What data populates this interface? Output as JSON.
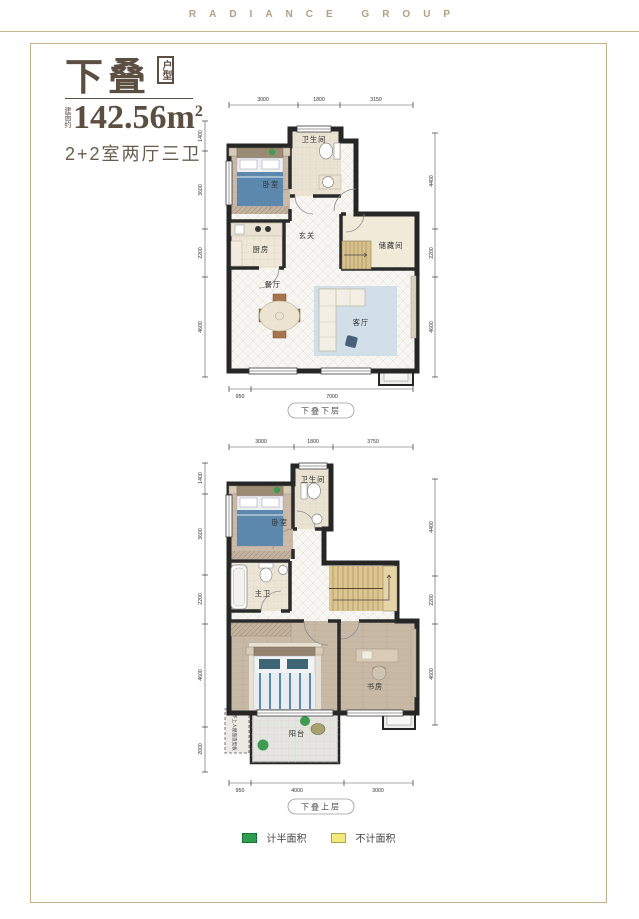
{
  "header": {
    "brand": "RADIANCE GROUP"
  },
  "title": {
    "name": "下叠",
    "badge": "户型",
    "area_prefix": "建面约",
    "area_value": "142.56",
    "area_unit": "m",
    "area_sup": "2",
    "layout": "2+2室两厅三卫"
  },
  "plan_lower": {
    "caption": "下叠下层",
    "rooms": {
      "bedroom": "卧室",
      "bathroom": "卫生间",
      "foyer": "玄关",
      "kitchen": "厨房",
      "storage": "储藏间",
      "dining": "餐厅",
      "living": "客厅"
    },
    "dims": {
      "top": [
        "3000",
        "1800",
        "3150"
      ],
      "left": [
        "1400",
        "3600",
        "2200",
        "4600"
      ],
      "right": [
        "4400",
        "2200",
        "4600"
      ],
      "bottom": [
        "950",
        "7000"
      ]
    }
  },
  "plan_upper": {
    "caption": "下叠上层",
    "rooms": {
      "bathroom": "卫生间",
      "bedroom": "卧室",
      "master_bath": "主卫",
      "study": "书房",
      "balcony": "阳台",
      "roof_note": "不上人屋面造型板"
    },
    "dims": {
      "top": [
        "3000",
        "1800",
        "3750"
      ],
      "left": [
        "1400",
        "3600",
        "2200",
        "4600",
        "2000"
      ],
      "right": [
        "4400",
        "2200",
        "4600"
      ],
      "bottom": [
        "950",
        "4000",
        "3000"
      ]
    }
  },
  "legend": {
    "half_area": {
      "label": "计半面积",
      "color": "#2f9e4e"
    },
    "excluded": {
      "label": "不计面积",
      "color": "#f2e97f"
    }
  },
  "colors": {
    "brand": "#b3a083",
    "accent": "#5c4e41",
    "frame": "#c6b08a",
    "wall": "#262626"
  }
}
